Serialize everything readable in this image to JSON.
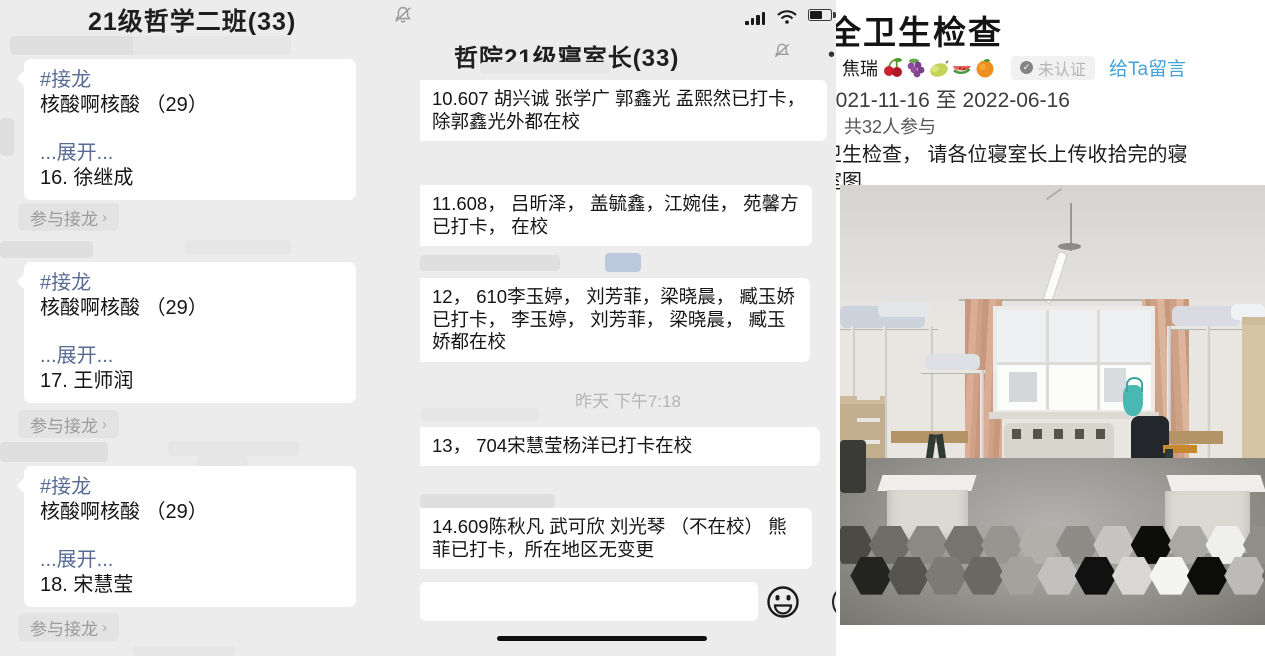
{
  "left_chat": {
    "title": "21级哲学二班(33)",
    "mute_icon": "mute-bell-icon",
    "join_button": "参与接龙",
    "join_chevron": "›",
    "messages": [
      {
        "tag": "#接龙",
        "title": "核酸啊核酸 （29）",
        "expand": "...展开...",
        "entry": "16. 徐继成"
      },
      {
        "tag": "#接龙",
        "title": "核酸啊核酸 （29）",
        "expand": "...展开...",
        "entry": "17. 王师润"
      },
      {
        "tag": "#接龙",
        "title": "核酸啊核酸 （29）",
        "expand": "...展开...",
        "entry": "18. 宋慧莹"
      }
    ]
  },
  "mid_chat": {
    "title": "哲院21级寝室长(33)",
    "mute_icon": "mute-bell-icon",
    "menu_dot": "•",
    "timestamp": "昨天 下午7:18",
    "messages": [
      "10.607 胡兴诚 张学广 郭鑫光 孟熙然已打卡， 除郭鑫光外都在校",
      "11.608， 吕昕泽， 盖毓鑫，江婉佳， 苑馨方已打卡， 在校",
      "12， 610李玉婷， 刘芳菲，梁晓晨， 臧玉娇已打卡， 李玉婷， 刘芳菲， 梁晓晨， 臧玉娇都在校",
      "13， 704宋慧莹杨洋已打卡在校",
      "14.609陈秋凡 武可欣 刘光琴 （不在校） 熊菲已打卡，所在地区无变更"
    ],
    "input_value": "",
    "status_icons": [
      "signal-bars-icon",
      "wifi-icon",
      "battery-icon"
    ],
    "toolbar_icons": [
      "emoji-smiley-icon",
      "plus-circle-icon"
    ]
  },
  "detail": {
    "title": "全卫生检查",
    "author": "焦瑞",
    "fruit_icons": [
      "cherries-icon",
      "grapes-icon",
      "pear-icon",
      "watermelon-icon",
      "tangerine-icon"
    ],
    "badge": "未认证",
    "badge_check": "✓",
    "message_link": "给Ta留言",
    "date_range": "2021-11-16 至 2022-06-16",
    "participants": "共32人参与",
    "desc_line1": "卫生检查， 请各位寝室长上传收拾完的寝",
    "desc_line2": "室图",
    "accent_blue": "#45a3d7",
    "link_blue": "#576b95"
  },
  "photo": {
    "censor_colors": [
      "#4c4b43",
      "#6e6d68",
      "#8a8984",
      "#75746f",
      "#969590",
      "#b0afaa",
      "#8d8c87",
      "#c6c5c1",
      "#0d0d0b",
      "#a9a8a3",
      "#efefeb",
      "#8f8e89",
      "#242420",
      "#55544e",
      "#7b7a74",
      "#696862",
      "#a3a29d",
      "#c2c1bd",
      "#111111",
      "#d8d7d3",
      "#f4f4f1",
      "#0c0c0a",
      "#bcbbb7",
      "#6f6e68"
    ]
  }
}
